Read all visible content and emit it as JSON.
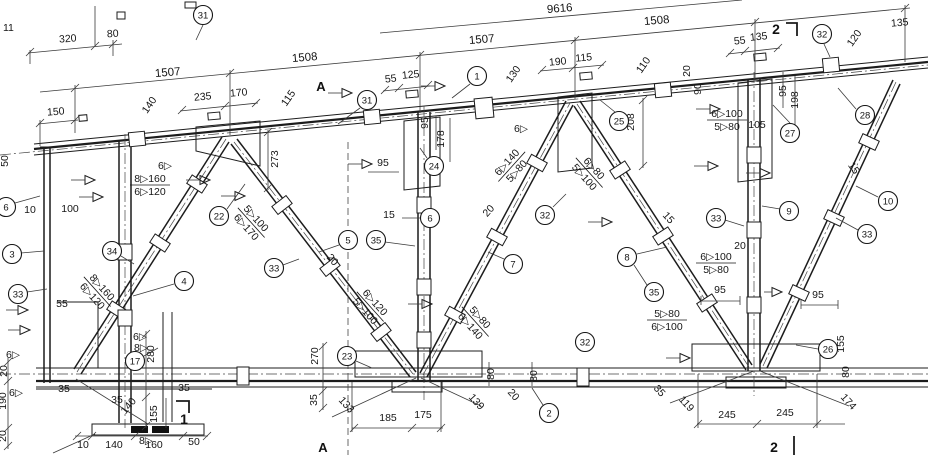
{
  "colors": {
    "ink": "#1a1a1a",
    "paper": "#ffffff"
  },
  "dims": {
    "d01": "11",
    "d02": "320",
    "d03": "80",
    "d04": "1507",
    "d05": "1508",
    "d06": "1507",
    "d07": "1508",
    "d08": "9616",
    "d09": "150",
    "d10": "140",
    "d11": "235",
    "d12": "170",
    "d13": "115",
    "d14": "273",
    "d15": "55",
    "d16": "125",
    "d17": "95",
    "d18": "178",
    "d19": "95",
    "d20": "15",
    "d21": "130",
    "d22": "190",
    "d23": "115",
    "d24": "110",
    "d25": "20",
    "d26": "90",
    "d27": "55",
    "d28": "135",
    "d29": "120",
    "d30": "135",
    "d31": "95",
    "d32": "198",
    "d33": "105",
    "d34": "208",
    "d35": "50",
    "d36": "10",
    "d37": "100",
    "d38": "20",
    "d39": "20",
    "d40": "15",
    "d41": "15",
    "d42": "20",
    "d43": "95",
    "d44": "95",
    "d45": "55",
    "d46": "20",
    "d47": "190",
    "d48": "20",
    "d49": "35",
    "d50": "280",
    "d51": "35",
    "d52": "35",
    "d53": "140",
    "d54": "155",
    "d55": "10",
    "d56": "140",
    "d57": "160",
    "d58": "50",
    "d59": "270",
    "d60": "35",
    "d61": "133",
    "d62": "185",
    "d63": "175",
    "d64": "139",
    "d65": "80",
    "d66": "20",
    "d67": "80",
    "d68": "35",
    "d69": "119",
    "d70": "245",
    "d71": "245",
    "d72": "174",
    "d73": "80",
    "d74": "155"
  },
  "welds": {
    "w1": {
      "top": "8▷160",
      "bot": "6▷120"
    },
    "w2": {
      "top": "5▷100",
      "bot": "6▷170"
    },
    "w3": {
      "top": "8▷160",
      "bot": "6▷120"
    },
    "w4": {
      "top": "6▷120",
      "bot": "5▷100"
    },
    "w5": {
      "top": "5▷80",
      "bot": "6▷140"
    },
    "w6": {
      "top": "6▷140",
      "bot": "5▷80"
    },
    "w7": {
      "top": "6▷80",
      "bot": "5▷100"
    },
    "w8": {
      "top": "6▷100",
      "bot": "5▷80"
    },
    "w9": {
      "top": "6▷100",
      "bot": "5▷80"
    },
    "w10": {
      "top": "5▷80",
      "bot": "6▷100"
    },
    "s1": "6▷",
    "s2": "8▷",
    "s3": "6▷",
    "s4": "6▷",
    "s5": "8▷",
    "s6": "6▷",
    "s7": "6▷"
  },
  "callouts": {
    "c01": "31",
    "c02": "31",
    "c03": "1",
    "c04": "25",
    "c05": "32",
    "c06": "28",
    "c07": "27",
    "c08": "10",
    "c09": "9",
    "c10": "33",
    "c11": "33",
    "c12": "6",
    "c13": "24",
    "c14": "22",
    "c15": "3",
    "c16": "33",
    "c17": "34",
    "c18": "4",
    "c19": "5",
    "c20": "33",
    "c21": "35",
    "c22": "7",
    "c23": "32",
    "c24": "8",
    "c25": "35",
    "c26": "32",
    "c27": "23",
    "c28": "17",
    "c29": "2",
    "c30": "26",
    "c31": "6"
  },
  "markers": {
    "a1": "A",
    "a2": "A",
    "s1": "1",
    "s2": "2",
    "s3": "2"
  }
}
